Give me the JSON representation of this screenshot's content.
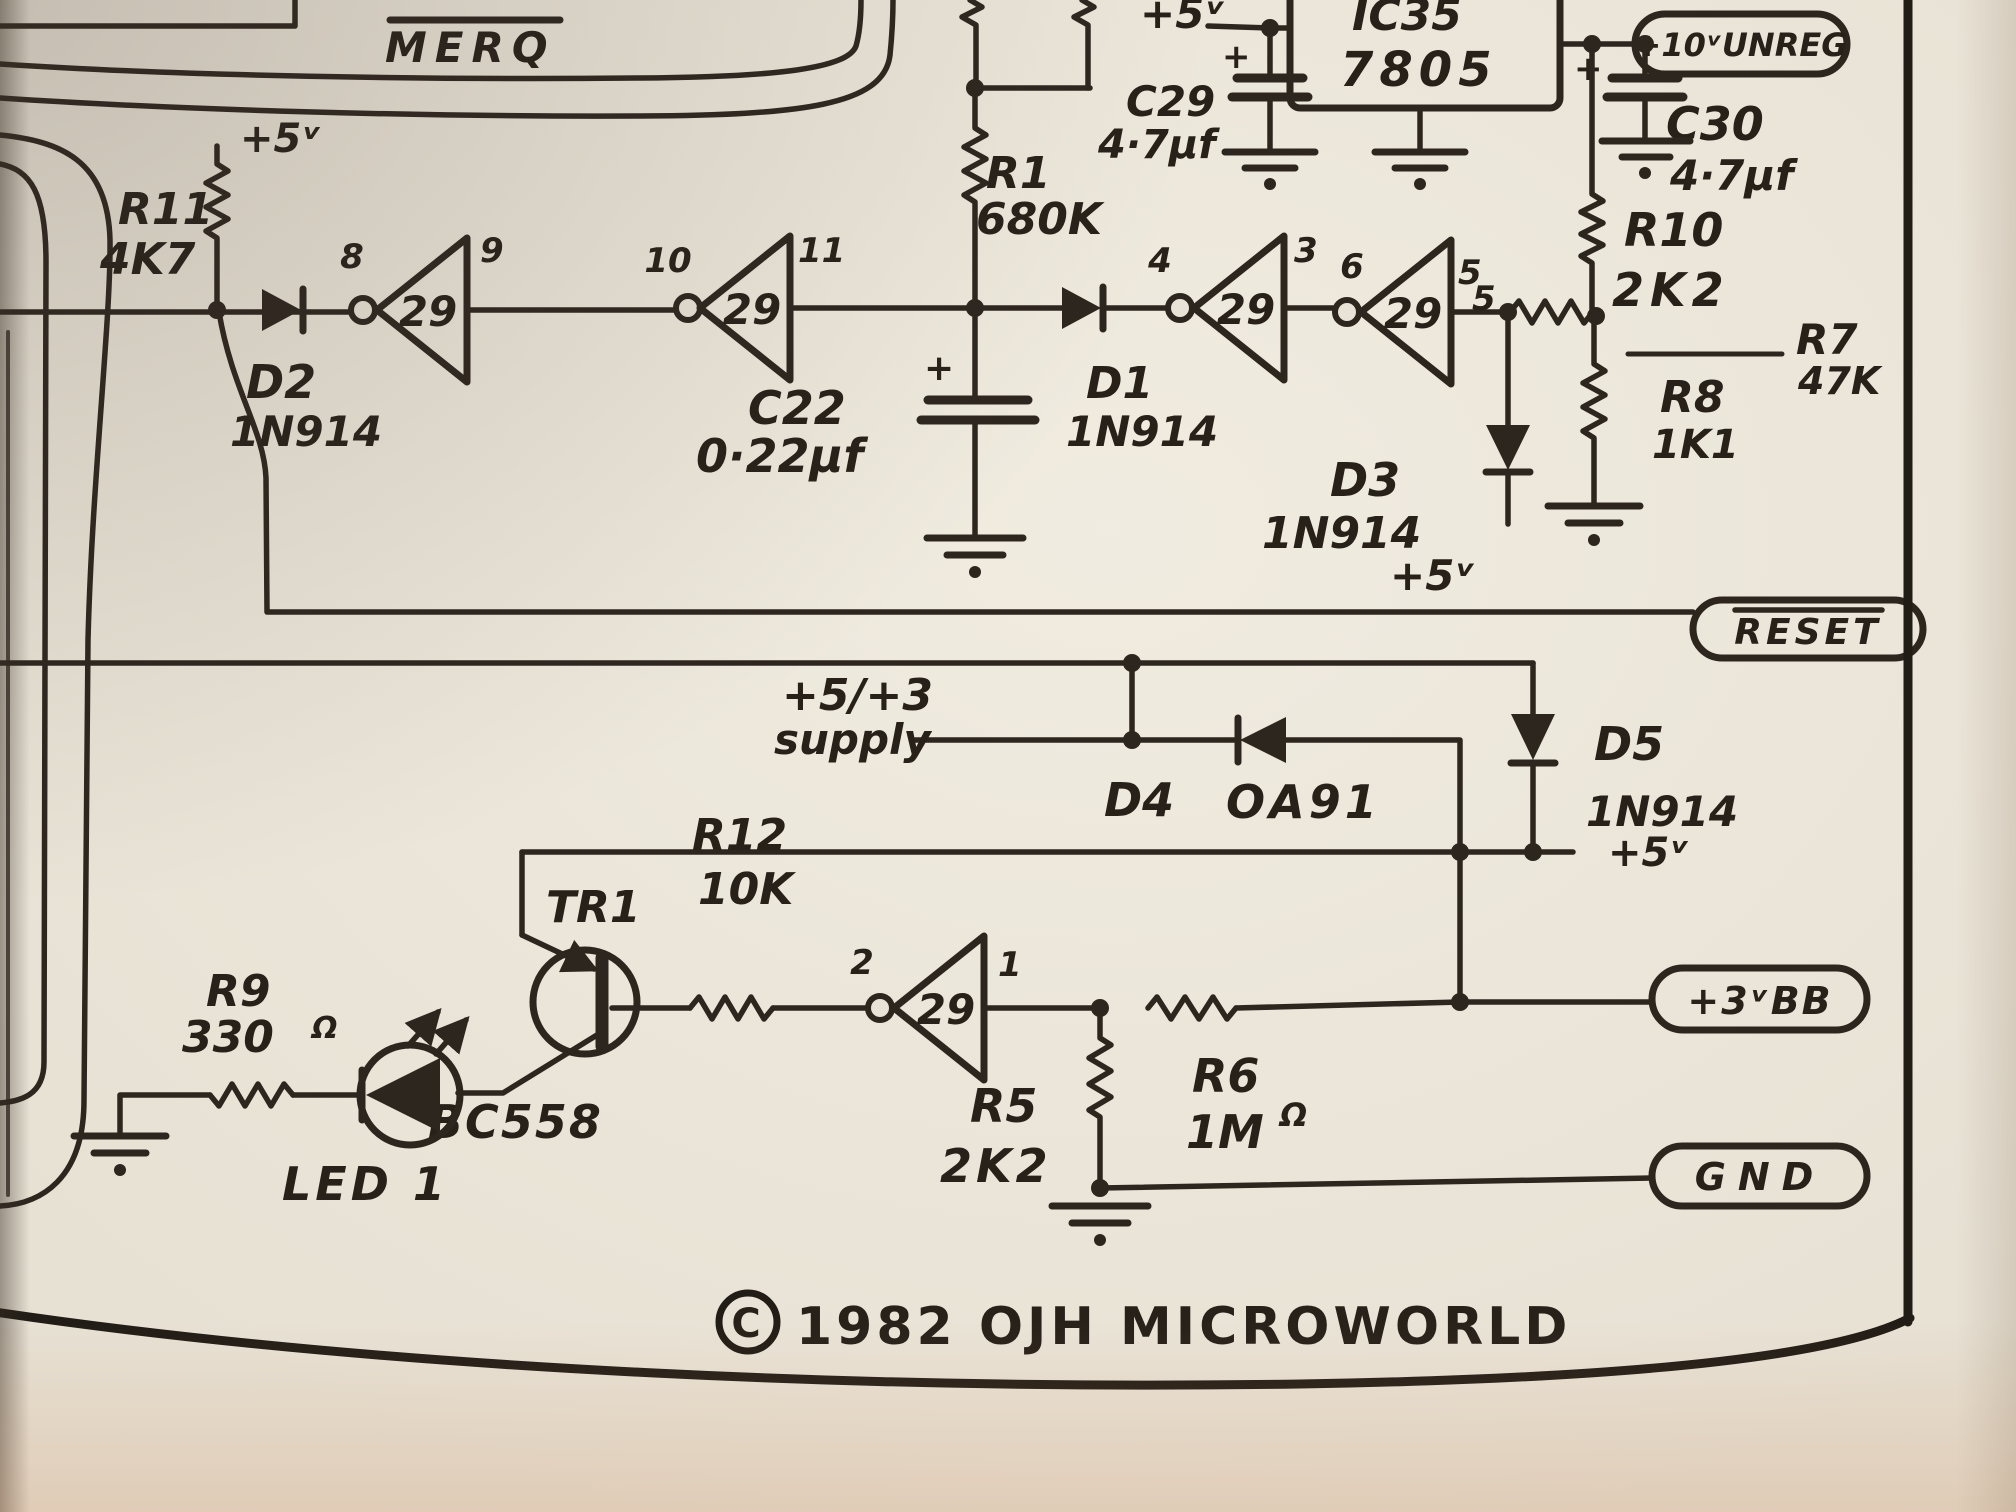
{
  "schematic": {
    "title_net": "MERQ",
    "copyright": {
      "symbol": "C",
      "text": "1982 OJH MICROWORLD"
    },
    "terminals": {
      "unreg": "+10ᵛUNREG",
      "reset": "RESET",
      "bb": "+3ᵛBB",
      "gnd": "GND"
    },
    "rails": {
      "r11_plus5": "+5ᵛ",
      "top_plus5": "+5ᵛ",
      "d3_plus5": "+5ᵛ",
      "d5_plus5": "+5ᵛ",
      "supply_line1": "+5/+3",
      "supply_line2": "supply"
    },
    "gates": [
      {
        "label": "29",
        "pin_in": "8",
        "pin_out": "9"
      },
      {
        "label": "29",
        "pin_in": "10",
        "pin_out": "11"
      },
      {
        "label": "29",
        "pin_in": "4",
        "pin_out": "3"
      },
      {
        "label": "29",
        "pin_in": "6",
        "pin_out": "5",
        "pin_out_alt": "5"
      },
      {
        "label": "29",
        "pin_in": "2",
        "pin_out": "1"
      }
    ],
    "ic": {
      "name": "IC35",
      "part": "7805"
    },
    "resistors": {
      "r11": {
        "name": "R11",
        "value": "4K7"
      },
      "r1": {
        "name": "R1",
        "value": "680K"
      },
      "r10": {
        "name": "R10",
        "value": "2K2"
      },
      "r7": {
        "name": "R7",
        "value": "47K"
      },
      "r8": {
        "name": "R8",
        "value": "1K1"
      },
      "r12": {
        "name": "R12",
        "value": "10K"
      },
      "r9": {
        "name": "R9",
        "value": "330",
        "unit": "Ω"
      },
      "r5": {
        "name": "R5",
        "value": "2K2"
      },
      "r6": {
        "name": "R6",
        "value": "1M",
        "unit": "Ω"
      }
    },
    "capacitors": {
      "c22": {
        "name": "C22",
        "value": "0·22µf",
        "plus": "+"
      },
      "c29": {
        "name": "C29",
        "value": "4·7µf",
        "plus": "+"
      },
      "c30": {
        "name": "C30",
        "value": "4·7µf",
        "plus": "+"
      }
    },
    "diodes": {
      "d2": {
        "name": "D2",
        "part": "1N914"
      },
      "d1": {
        "name": "D1",
        "part": "1N914"
      },
      "d3": {
        "name": "D3",
        "part": "1N914"
      },
      "d4": {
        "name": "D4",
        "part": "OA91"
      },
      "d5": {
        "name": "D5",
        "part": "1N914"
      }
    },
    "transistor": {
      "name": "TR1",
      "part": "BC558"
    },
    "led": {
      "name": "LED 1"
    }
  }
}
